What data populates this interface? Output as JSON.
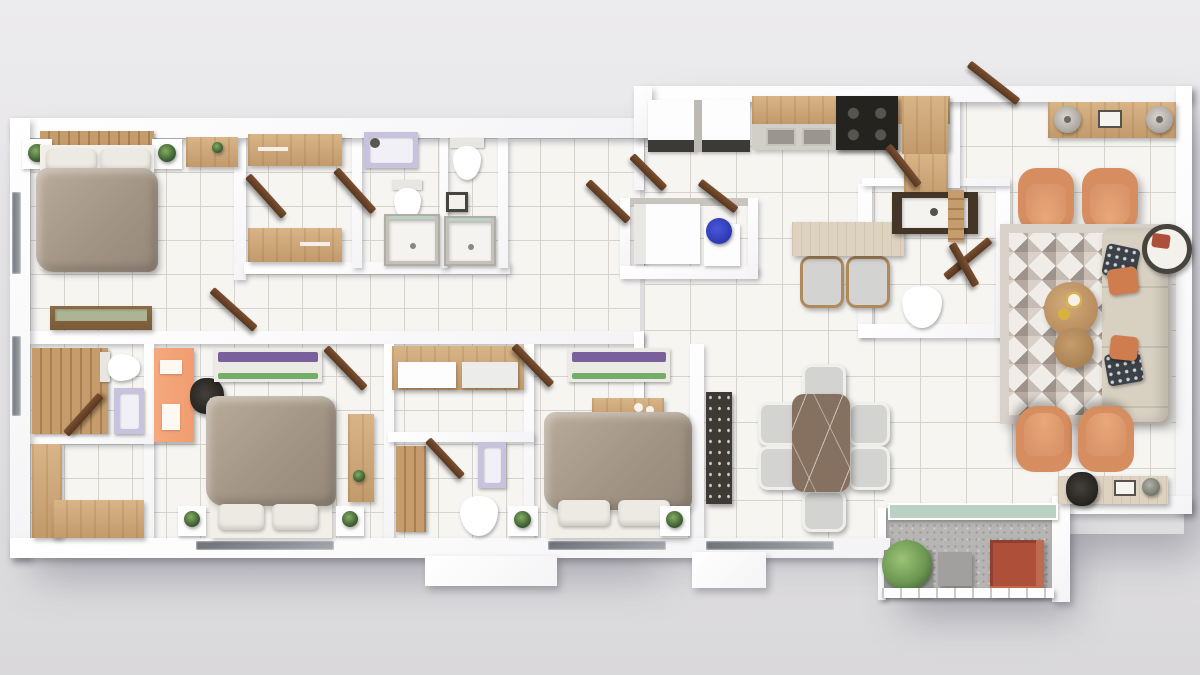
{
  "scene": {
    "kind": "3d-floor-plan-top-down-render",
    "rooms": [
      {
        "name": "master-bedroom",
        "furniture": [
          "double-bed",
          "wood-headboard",
          "nightstand-left",
          "nightstand-right",
          "plants",
          "wood-console",
          "bench"
        ]
      },
      {
        "name": "wardrobe-room",
        "furniture": [
          "wardrobe-top",
          "wardrobe-bottom"
        ]
      },
      {
        "name": "bathroom-a",
        "furniture": [
          "washer",
          "toilet",
          "shower"
        ]
      },
      {
        "name": "bathroom-b",
        "furniture": [
          "toilet",
          "wall-sink",
          "shower"
        ]
      },
      {
        "name": "bathroom-c",
        "furniture": [
          "wood-slat-wall",
          "toilet",
          "vanity"
        ]
      },
      {
        "name": "storage-room",
        "furniture": [
          "l-shaped-wood-cabinet"
        ]
      },
      {
        "name": "bedroom-2",
        "furniture": [
          "orange-desk",
          "office-chair",
          "bench",
          "double-bed",
          "nightstands",
          "wood-dresser"
        ]
      },
      {
        "name": "closet-bathroom-d",
        "furniture": [
          "wardrobe",
          "wood-slat-wall",
          "vanity",
          "toilet"
        ]
      },
      {
        "name": "bedroom-3",
        "furniture": [
          "bench",
          "wood-side-table",
          "double-bed",
          "nightstands"
        ]
      },
      {
        "name": "utility",
        "furniture": [
          "washer",
          "dryer",
          "storage-niche",
          "blue-basin"
        ]
      },
      {
        "name": "kitchen",
        "furniture": [
          "wood-counter",
          "double-sink",
          "cooktop",
          "corner-counter"
        ]
      },
      {
        "name": "breakfast-bar",
        "furniture": [
          "stone-table",
          "two-chairs"
        ]
      },
      {
        "name": "powder-room",
        "furniture": [
          "framed-vanity",
          "toilet"
        ]
      },
      {
        "name": "dining-room",
        "furniture": [
          "marble-table",
          "six-chairs",
          "bar-cabinet"
        ]
      },
      {
        "name": "living-room",
        "furniture": [
          "entry-door",
          "console-with-lamps",
          "four-orange-armchairs",
          "triangle-rug",
          "sofa",
          "coffee-tables",
          "side-table",
          "desk",
          "desk-chair"
        ]
      },
      {
        "name": "balcony",
        "furniture": [
          "glass-railing",
          "planter",
          "plant",
          "side-table",
          "terracotta-lounger"
        ]
      }
    ]
  },
  "colors": {
    "background": "#ecebed",
    "wall": "#fbfbfc",
    "floor": "#f6f5f2",
    "grid": "#d6d3cd",
    "wood": "#cfa878",
    "woodDark": "#8a5e3c",
    "door": "#5f3d28",
    "duvet": "#a39584",
    "pillow": "#edeae3",
    "orangeChair": "#d68d60",
    "orangeChairInner": "#e8a878",
    "sofa": "#d8d1c2",
    "rugBase": "#f0ece7",
    "marble": "#86705f",
    "balconyFloor": "#b7b5b3",
    "terracotta": "#ad4f39",
    "plant": "#6d9853",
    "plantDark": "#31512b",
    "lavender": "#c7c2dd",
    "blue": "#2c38b2",
    "orangeDesk": "#f19c70",
    "benchPurple": "#7a5f9d",
    "benchGreen": "#74ad68",
    "chairGray": "#d3d3d1",
    "glass": "#b9d2c3",
    "dark": "#24231f",
    "travertine": "#ded3c0"
  }
}
